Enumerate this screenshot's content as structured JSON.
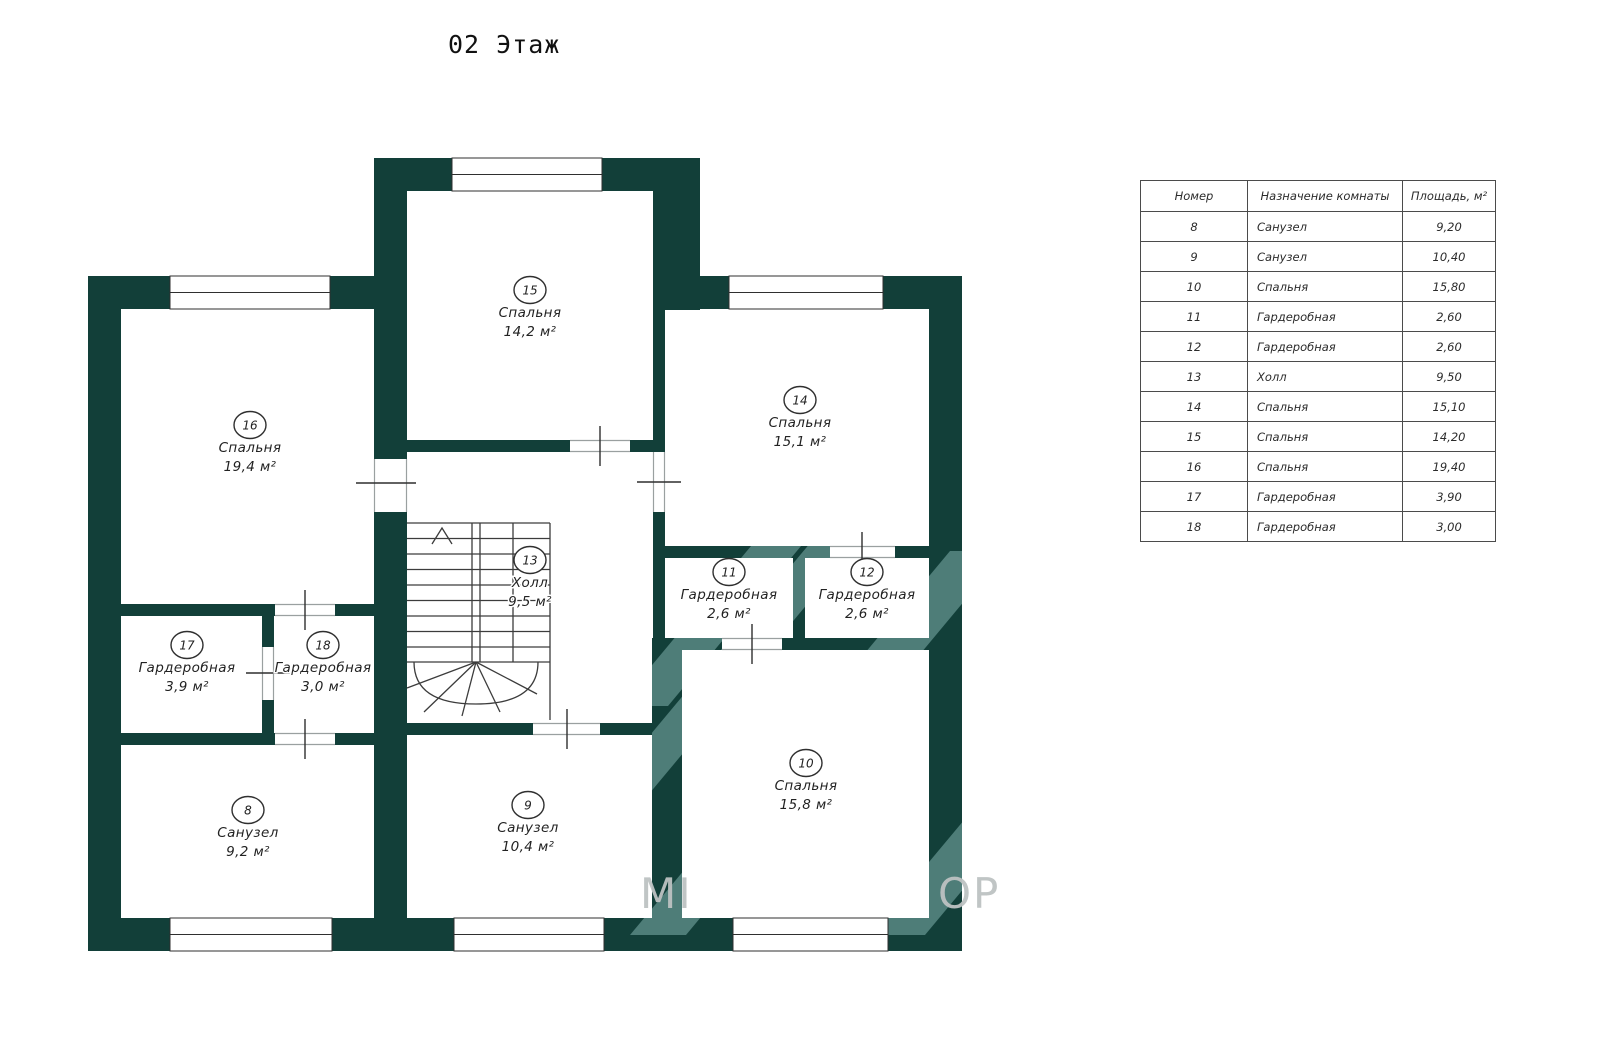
{
  "title": "02 Этаж",
  "plan": {
    "rooms": [
      {
        "number": "8",
        "name": "Санузел",
        "area": "9,2 м²"
      },
      {
        "number": "9",
        "name": "Санузел",
        "area": "10,4 м²"
      },
      {
        "number": "10",
        "name": "Спальня",
        "area": "15,8 м²"
      },
      {
        "number": "11",
        "name": "Гардеробная",
        "area": "2,6 м²"
      },
      {
        "number": "12",
        "name": "Гардеробная",
        "area": "2,6 м²"
      },
      {
        "number": "13",
        "name": "Холл",
        "area": "9,5 м²"
      },
      {
        "number": "14",
        "name": "Спальня",
        "area": "15,1 м²"
      },
      {
        "number": "15",
        "name": "Спальня",
        "area": "14,2 м²"
      },
      {
        "number": "16",
        "name": "Спальня",
        "area": "19,4 м²"
      },
      {
        "number": "17",
        "name": "Гардеробная",
        "area": "3,9 м²"
      },
      {
        "number": "18",
        "name": "Гардеробная",
        "area": "3,0 м²"
      }
    ],
    "watermark": {
      "left": "МІ",
      "right": "ОР"
    },
    "colors": {
      "wall": "#123f39",
      "watermark_band": "#4e7d78",
      "watermark_text": "#bdc2c2"
    }
  },
  "table": {
    "headers": [
      "Номер",
      "Назначение комнаты",
      "Площадь, м²"
    ],
    "rows": [
      {
        "number": "8",
        "purpose": "Санузел",
        "area": "9,20"
      },
      {
        "number": "9",
        "purpose": "Санузел",
        "area": "10,40"
      },
      {
        "number": "10",
        "purpose": "Спальня",
        "area": "15,80"
      },
      {
        "number": "11",
        "purpose": "Гардеробная",
        "area": "2,60"
      },
      {
        "number": "12",
        "purpose": "Гардеробная",
        "area": "2,60"
      },
      {
        "number": "13",
        "purpose": "Холл",
        "area": "9,50"
      },
      {
        "number": "14",
        "purpose": "Спальня",
        "area": "15,10"
      },
      {
        "number": "15",
        "purpose": "Спальня",
        "area": "14,20"
      },
      {
        "number": "16",
        "purpose": "Спальня",
        "area": "19,40"
      },
      {
        "number": "17",
        "purpose": "Гардеробная",
        "area": "3,90"
      },
      {
        "number": "18",
        "purpose": "Гардеробная",
        "area": "3,00"
      }
    ]
  }
}
